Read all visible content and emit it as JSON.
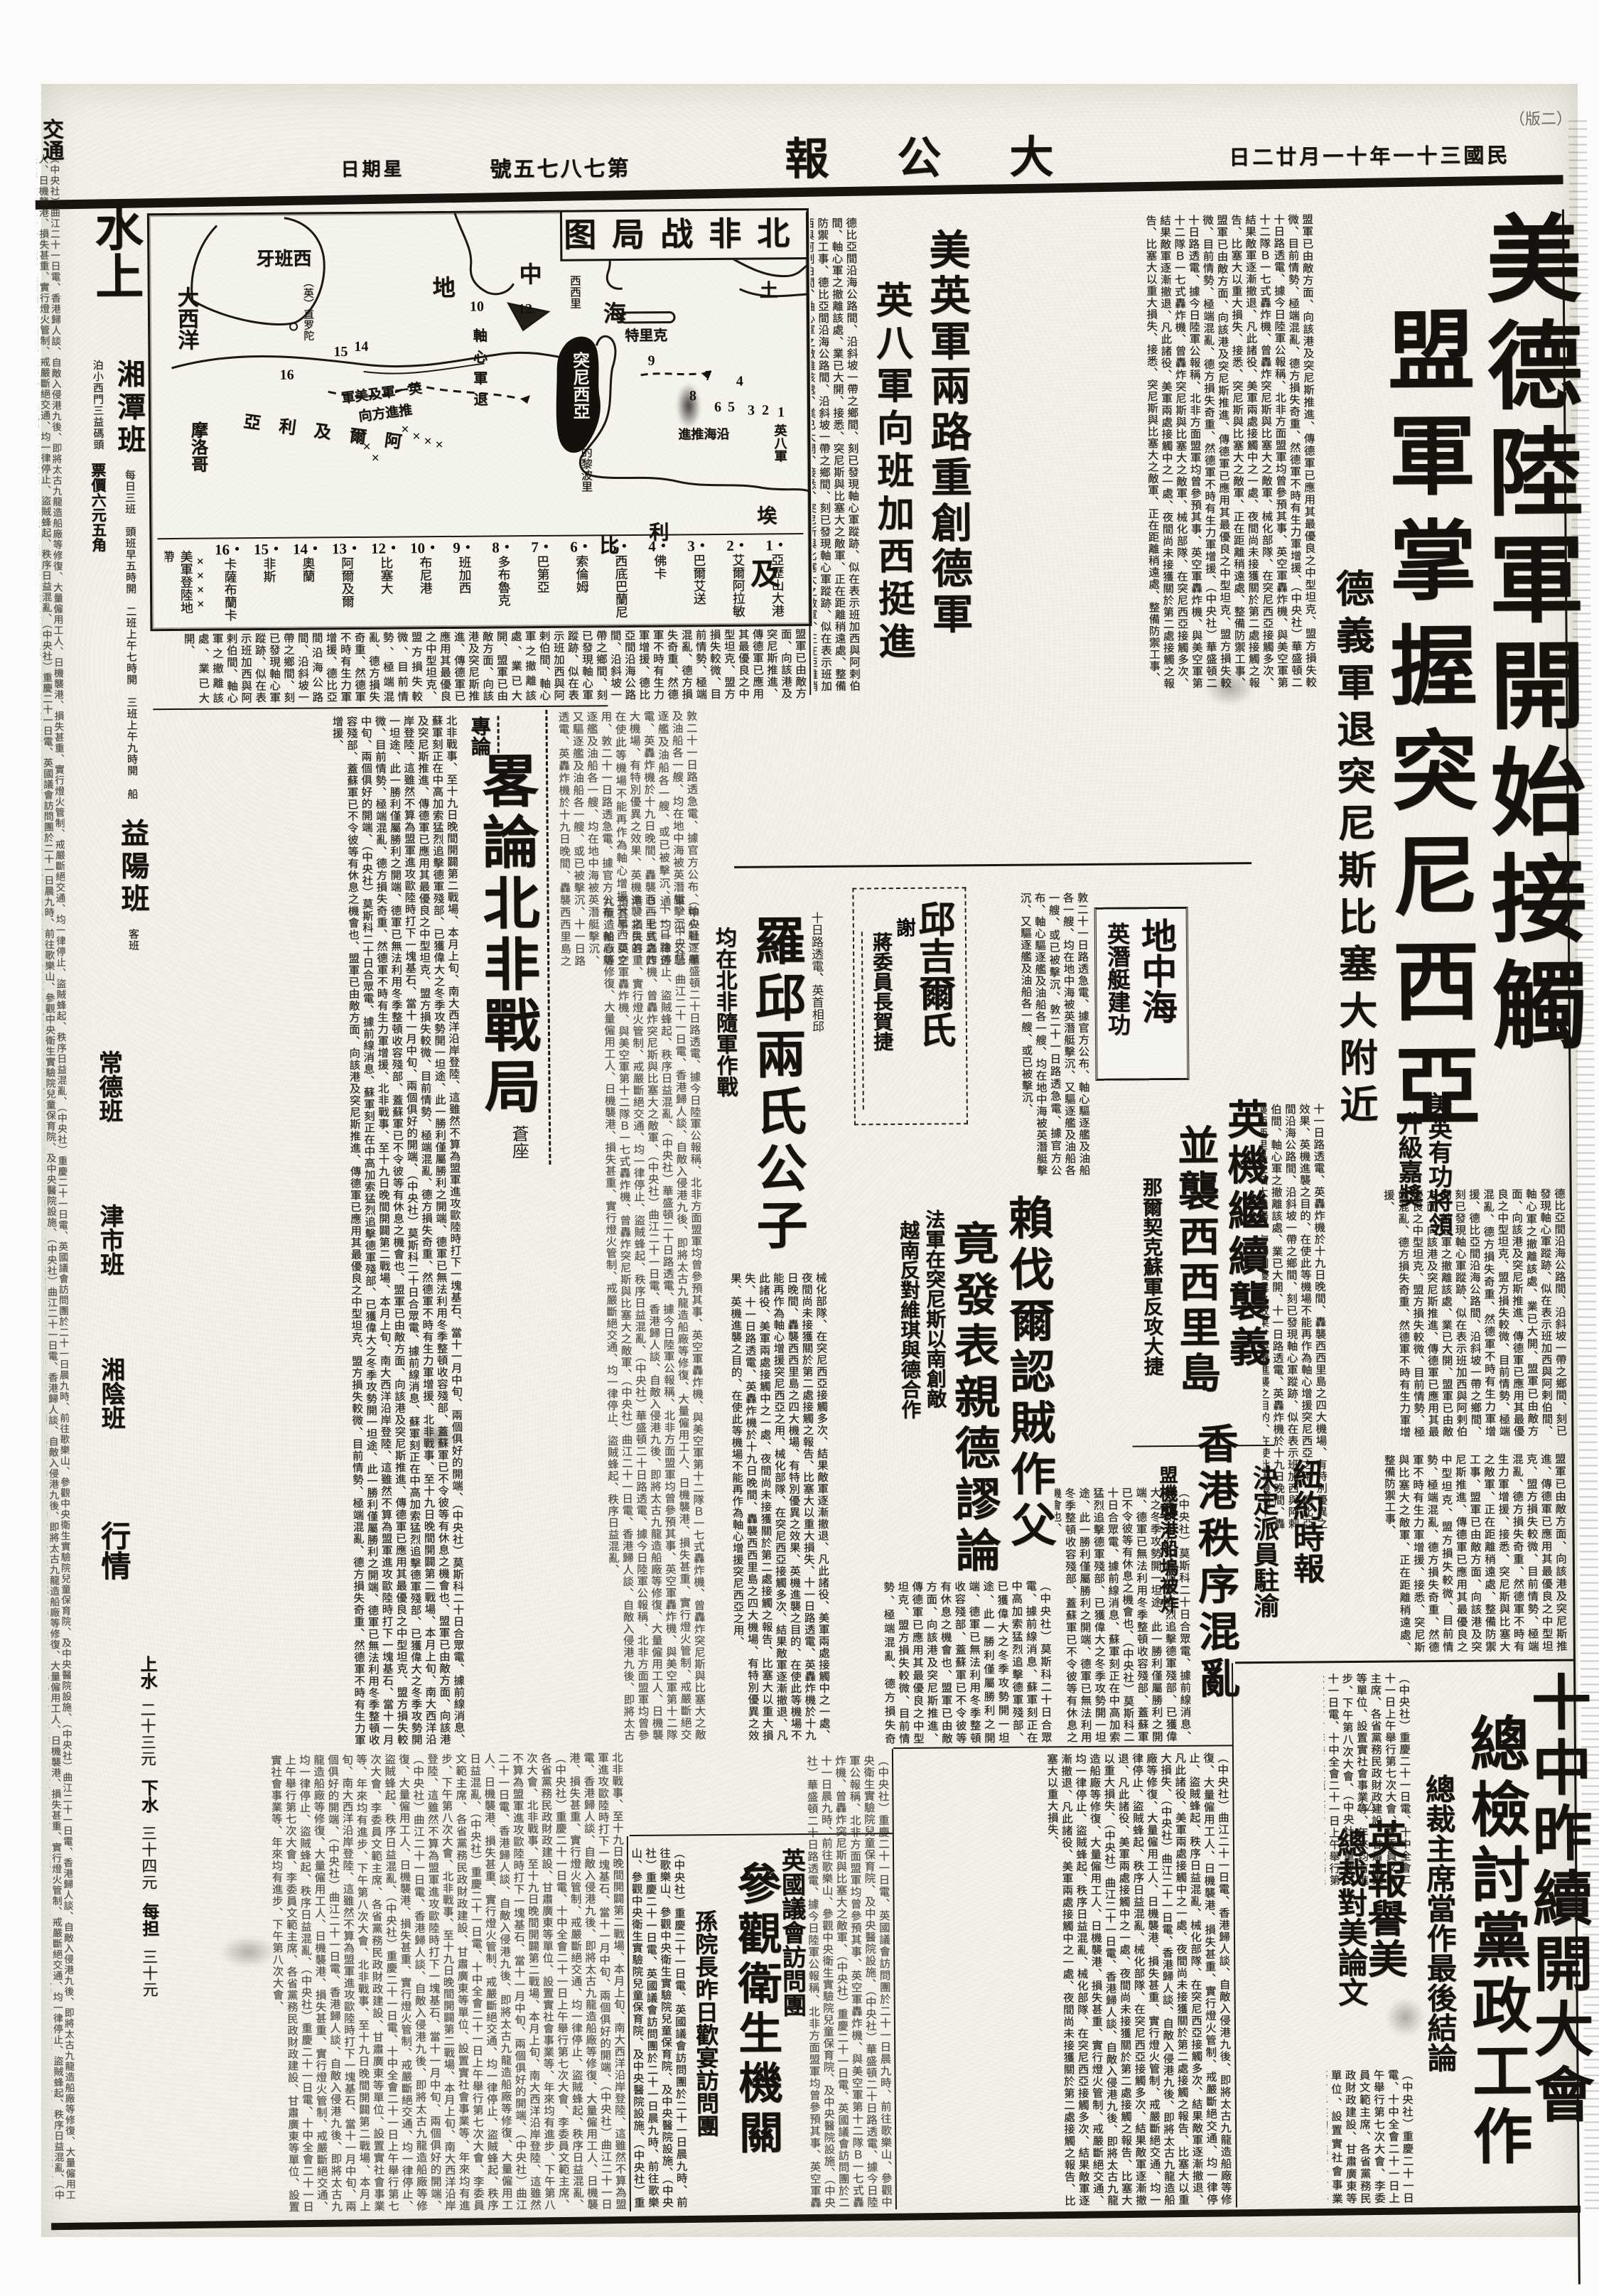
{
  "header": {
    "weekday": "星期日",
    "issue_no": "第七八七五號",
    "masthead": "大公報",
    "date": "民國三十一年十一月廿二日",
    "page_label": "（二版）"
  },
  "left_rail": {
    "top_label": "交通",
    "section_head": "水上",
    "items": [
      {
        "name": "湘潭班",
        "note": "每日三班　頭班早五時開　二班上午七時開　三班上午九時開",
        "note2": "船泊小西門三益碼頭",
        "price": "票價六元五角"
      },
      {
        "name": "益陽班",
        "note": "客班"
      },
      {
        "name": "常德班",
        "note": ""
      },
      {
        "name": "津市班",
        "note": ""
      },
      {
        "name": "湘陰班",
        "note": ""
      },
      {
        "name": "行情",
        "note": ""
      }
    ],
    "rates": [
      {
        "label": "上水",
        "value": "二十三元"
      },
      {
        "label": "下水",
        "value": "三十四元"
      },
      {
        "label": "每担",
        "value": "三十元"
      }
    ]
  },
  "map": {
    "title": "北非战局图",
    "labels": {
      "atlantic": "大西洋",
      "spain": "西班牙",
      "gibraltar": "（英）直罗陀",
      "med1": "地",
      "med2": "中",
      "med3": "海",
      "turkey": "土",
      "crete": "克里特",
      "sicily": "西西里",
      "tunisia": "突尼西亞",
      "axis_retreat": "軸心軍退",
      "allied_adv1": "英一軍及美軍",
      "allied_adv2": "推進方向",
      "eighth_a": "英八軍",
      "eighth_b": "沿海推進",
      "tripoli": "的黎波里",
      "libya1": "利",
      "libya2": "比",
      "egypt1": "埃",
      "egypt2": "及",
      "algeria": "阿爾及利亞",
      "morocco": "摩洛哥"
    },
    "landing_legend": "美軍登陸地帶",
    "landing_marks": "××××",
    "legend": [
      {
        "n": "1",
        "name": "亞歷山大港"
      },
      {
        "n": "2",
        "name": "艾爾阿拉敏"
      },
      {
        "n": "3",
        "name": "巴爾艾送"
      },
      {
        "n": "4",
        "name": "佛卡"
      },
      {
        "n": "5",
        "name": "西底巴蘭尼"
      },
      {
        "n": "6",
        "name": "索倫姆"
      },
      {
        "n": "7",
        "name": "巴第亞"
      },
      {
        "n": "8",
        "name": "多布魯克"
      },
      {
        "n": "9",
        "name": "班加西"
      },
      {
        "n": "10",
        "name": "布尼港"
      },
      {
        "n": "12",
        "name": "比塞大"
      },
      {
        "n": "13",
        "name": "阿爾及爾"
      },
      {
        "n": "14",
        "name": "奧蘭"
      },
      {
        "n": "15",
        "name": "非斯"
      },
      {
        "n": "16",
        "name": "卡薩布蘭卡"
      }
    ]
  },
  "heads": {
    "main1": "美德陸軍開始接觸",
    "main2": "盟軍掌握突尼西亞",
    "deck": "德義軍退突尼斯比塞大附近",
    "us_uk": "美英軍兩路重創德軍",
    "eighth": "英八軍向班加西挺進",
    "editorial_kicker": "專論",
    "editorial_title": "畧論北非戰局",
    "editorial_byline": "蒼座",
    "sons_kicker": "十日路透電、英首相邱",
    "sons": "羅邱兩氏公子",
    "sons_deck": "均在北非隨軍作戰",
    "churchill": "邱吉爾氏",
    "churchill_thanks": "謝",
    "churchill_deck": "蔣委員長賀捷",
    "med": "地中海",
    "med_deck": "英潛艇建功",
    "raf1": "英機繼續襲義",
    "raf2": "並襲西西里島",
    "nalchik": "那爾契克蘇軍反攻大捷",
    "laval1": "賴伐爾認賊作父",
    "laval2": "竟發表親德謬論",
    "laval_deck1": "法軍在突尼斯以南創敵",
    "laval_deck2": "越南反對維琪與德合作",
    "hk": "香港秩序混亂",
    "hk_deck": "盟機襲港船塢被炸",
    "promo1": "美英有功將領",
    "promo2": "升級嘉獎",
    "nyt1": "紐約時報",
    "nyt2": "決定派員駐渝",
    "plenum1": "十中昨續開大會",
    "plenum2": "總檢討黨政工作",
    "plenum_deck": "總裁主席當作最後結論",
    "praise1": "英報譽美",
    "praise2": "總裁對美論文",
    "praise_marks": "△△",
    "visit_kicker": "英國議會訪問團",
    "visit": "參觀衛生機關",
    "visit_deck": "孫院長昨日歡宴訪問團"
  },
  "body_fragments": {
    "f1": "盟軍已由敵方面、向該港及突尼斯推進、傳德軍已應用其最優良之中型坦克、盟方損失較微、目前情勢、極端混亂、德方損失奇重、然德軍不時有生力軍增援、",
    "f2": "（中央社）華盛頓二十日路透電、據今日陸軍公報稱、北非方面盟軍均曾參預其事、英空軍轟炸機、與美空軍第十二隊Ｂ一七式轟炸機、曾轟炸突尼斯與比塞大之敵軍、",
    "f3": "械化部隊、在突尼西亞接觸多次、結果敵軍逐漸撤退、凡此諸役、美軍兩處接觸中之一處、夜間尚未接獲關於第二處接觸之報告、比塞大以重大損失、",
    "f4": "接悉、突尼斯與比塞大之敵軍、正在距離稍遠處、整備防禦工事、",
    "f5": "（中央社）莫斯科二十日合眾電、據前線消息、蘇軍刻正在中高加索猛烈追擊德軍殘部、已獲偉大之冬季攻勢開一坦途、此一勝利僅屬勝利之開端、德軍已無法利用冬季整頓收容殘部、蓋蘇軍已不令彼等有休息之機會也、",
    "f6": "（中央社）曲江二十一日電、香港歸人談、自敵入侵港九後、即將太古九龍造船廠等修復、大量僱用工人、日機襲港、損失甚重、實行燈火管制、戒嚴斷絕交通、均一律停止、盜賊蜂起、秩序日益混亂、",
    "f7": "北非戰事、至十九日晚間開闢第二戰場、本月上旬、南大西洋沿岸登陸、這雖然不算為盟軍進攻歐陸時打下一塊基石、當十一月中旬、兩個俱好的開端、",
    "f8": "（中央社）重慶二十一日電、英國議會訪問團於二十一日晨九時、前往歌樂山、參觀中央衛生實驗院兒童保育院、及中央醫院設施、",
    "f9": "（中央社）重慶二十一日電、十中全會二十一日上午舉行第七次大會、李委員文範主席、各省黨務民政財政建設、甘肅廣東等單位、設置實社會事業等、年來均有進步、下午第八次大會、",
    "f10": "敦二十一日路透急電、據官方公布、軸心驅逐艦及油船各一艘、均在地中海被英潛艇擊沉、又驅逐艦及油船各一艘、或已被擊沉、",
    "f11": "十一日路透電、英轟炸機於十九日晚間、轟襲西西里島之四大機場、有特別優異之效果、英機進襲之目的、在使此等機場不能再作為軸心增援突尼西亞之用、",
    "f12": "德比亞間沿海公路間、沿斜坡一帶之鄉間、刻已發現軸心軍蹤跡、似在表示班加西與阿剌伯間、軸心軍之撤離該處、業已大開、"
  }
}
